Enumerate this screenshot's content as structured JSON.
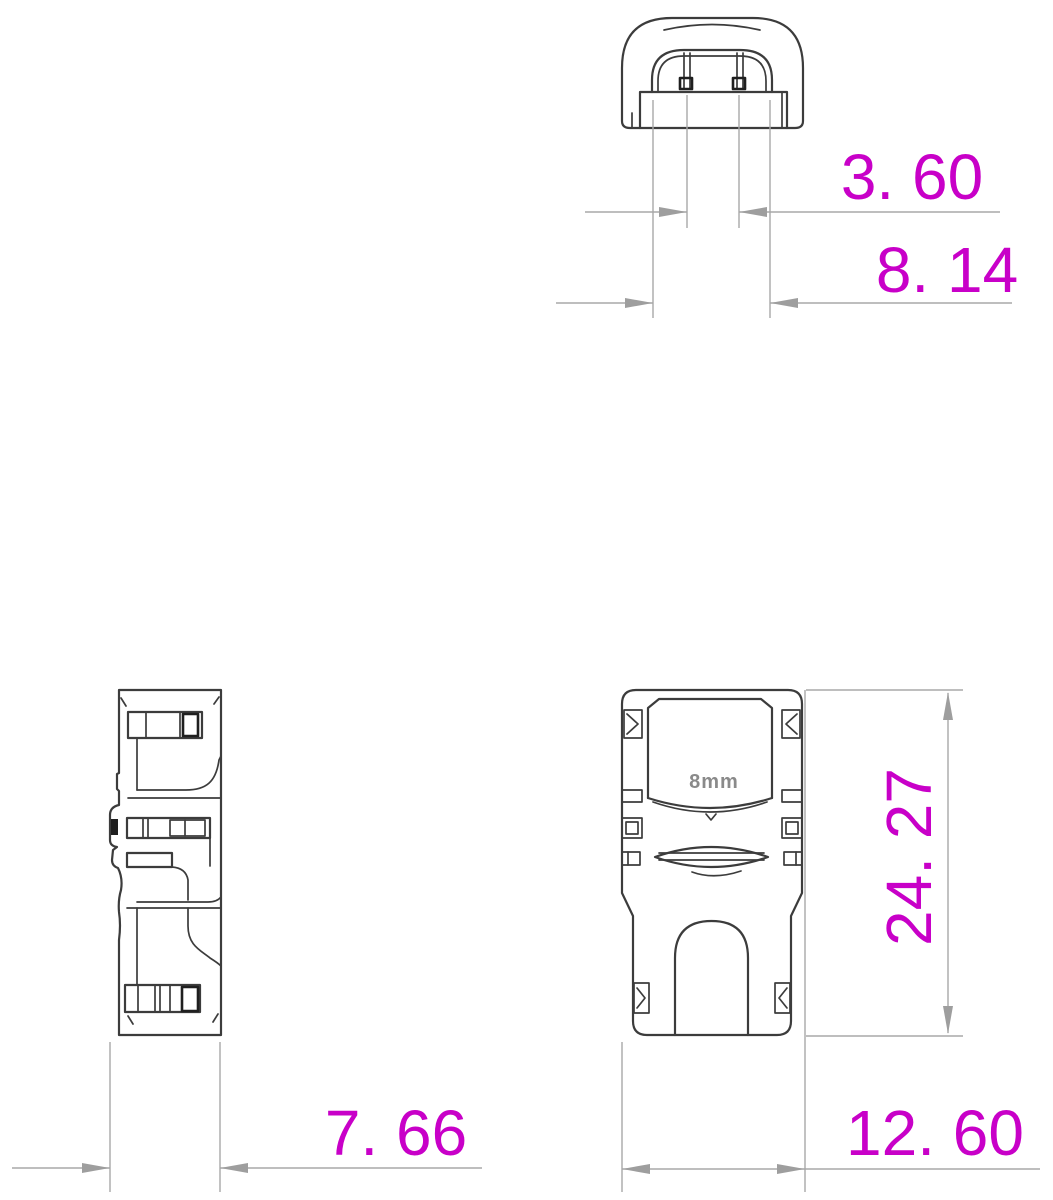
{
  "drawing": {
    "views": {
      "top": {
        "name": "top view of connector cap"
      },
      "side": {
        "name": "side view of connector body"
      },
      "front": {
        "name": "front view of connector body",
        "label": "8mm"
      }
    },
    "dimensions": {
      "pin_spacing": "3. 60",
      "cap_width": "8. 14",
      "side_depth": "7. 66",
      "body_height": "24. 27",
      "body_width": "12. 60"
    },
    "colors": {
      "outline": "#3c3c3c",
      "dimension_lines": "#a8a8a8",
      "dimension_text": "#c800c8",
      "label_text": "#8a8a8a",
      "background": "#ffffff"
    }
  }
}
